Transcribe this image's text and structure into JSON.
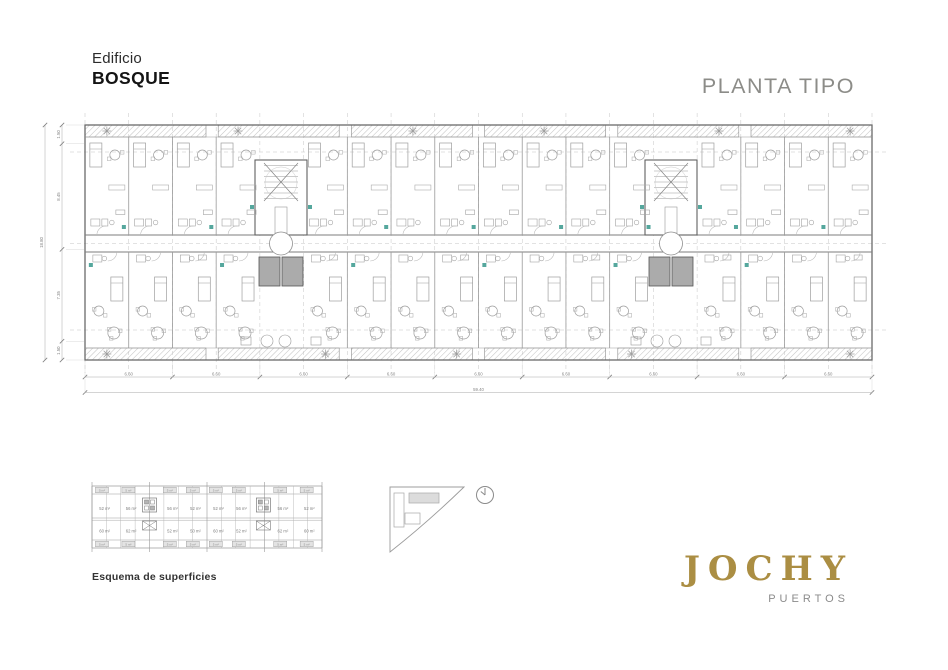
{
  "header": {
    "building_label": "Edificio",
    "building_name": "BOSQUE",
    "sheet_title": "PLANTA TIPO"
  },
  "floor_plan": {
    "dim_bottom_segments": [
      "6.60",
      "6.60",
      "6.60",
      "6.60",
      "6.60",
      "6.60",
      "6.60",
      "6.60",
      "6.60"
    ],
    "dim_bottom_total": "59.40",
    "dim_left_segments": [
      "1.50",
      "8.45",
      "7.35",
      "1.50"
    ],
    "dim_left_total": "18.80"
  },
  "surface_scheme": {
    "caption": "Esquema de superficies",
    "upper_unit_areas": [
      "52 m²",
      "56 m²",
      "56 m²",
      "52 m²",
      "52 m²",
      "56 m²",
      "56 m²",
      "52 m²"
    ],
    "lower_unit_areas": [
      "60 m²",
      "62 m²",
      "52 m²",
      "50 m²",
      "60 m²",
      "52 m²",
      "62 m²",
      "60 m²"
    ],
    "balcony_area": "5 m²"
  },
  "logo": {
    "brand": "JOCHY",
    "subtitle": "PUERTOS"
  },
  "colors": {
    "brand_gold": "#ab8e43",
    "title_gray": "#8c8c88",
    "accent_teal": "#55a79d",
    "elevator_gray": "#ababab"
  }
}
